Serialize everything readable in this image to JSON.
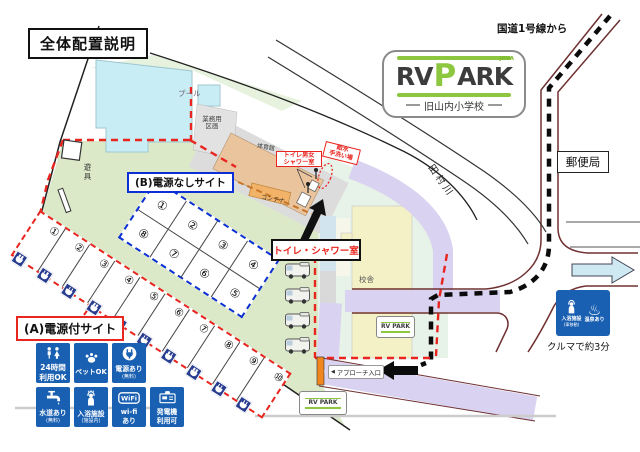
{
  "title": "全体配置説明",
  "labels": {
    "route_from": "国道1号線から",
    "post_office": "郵便局",
    "river": "田村川",
    "pool": "プール",
    "work1": "業務用",
    "work2": "区画",
    "gym": "体育館",
    "gymtoilet1": "トイレ男女",
    "gymtoilet2": "シャワー室",
    "water1": "給水",
    "water2": "手洗い場",
    "container": "コンテナ",
    "playground": "遊具",
    "school": "校舎",
    "toilet_shower": "トイレ・シャワー室",
    "approach_tri": "◀",
    "approach": "アプローチ入口",
    "car_time": "クルマで約3分",
    "site_a": "(A)電源付サイト",
    "site_b": "(B)電源なしサイト"
  },
  "logo": {
    "rv": "RV",
    "p": "P",
    "ark": "ARK",
    "assoc": "JRVA",
    "school": "旧山内小学校",
    "mini": "RV PARK"
  },
  "sites_a": [
    "①",
    "②",
    "③",
    "④",
    "⑤",
    "⑥",
    "⑦",
    "⑧",
    "⑨",
    "⑩"
  ],
  "sites_b_top": [
    "①",
    "②",
    "③",
    "④"
  ],
  "sites_b_bottom": [
    "⑧",
    "⑦",
    "⑥",
    "⑤"
  ],
  "legend_row1": [
    {
      "label1": "24時間",
      "label2": "利用OK"
    },
    {
      "label1": "ペットOK"
    },
    {
      "label1": "電源あり",
      "note": "(無料)"
    }
  ],
  "legend_row2": [
    {
      "label1": "水道あり",
      "note": "(無料)"
    },
    {
      "label1": "入浴施設",
      "note": "(施設内)"
    },
    {
      "label1": "wi-fi",
      "label2": "あり",
      "icon_text": "WiFi"
    },
    {
      "label1": "発電機",
      "label2": "利用可"
    }
  ],
  "onsen_badge": {
    "bath": "入浴施設",
    "bath_note": "(車移動)",
    "onsen": "温泉あり",
    "spa_mark": "♨"
  },
  "colors": {
    "accent_red": "#e8251f",
    "accent_blue": "#0b2fd4",
    "legend_blue": "#1a60b2",
    "brand_green": "#8dc63f",
    "road_purple": "#d9d2f0",
    "field_green": "#dbe9c9",
    "badge_navy": "#283c8f"
  }
}
